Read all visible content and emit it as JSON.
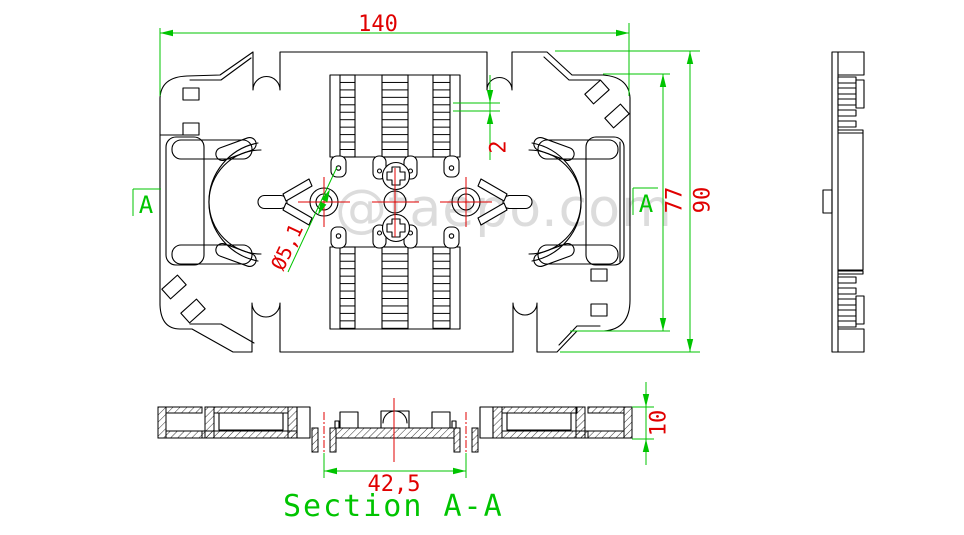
{
  "drawing": {
    "watermark": "@taepo.com",
    "dimensions": {
      "total_width": "140",
      "total_height": "90",
      "inner_height": "77",
      "comb_slot_pitch": "2",
      "hole_diameter": "Ø5,1",
      "clip_spacing": "42,5",
      "tray_thickness": "10"
    },
    "section": {
      "title": "Section A-A",
      "marker_left": "A",
      "marker_right": "A"
    },
    "colors": {
      "background": "#ffffff",
      "object_lines": "#000000",
      "dimension_lines": "#00c400",
      "dimension_text": "#e00000",
      "centerlines": "#e00000",
      "watermark": "#d9d9d9"
    }
  }
}
